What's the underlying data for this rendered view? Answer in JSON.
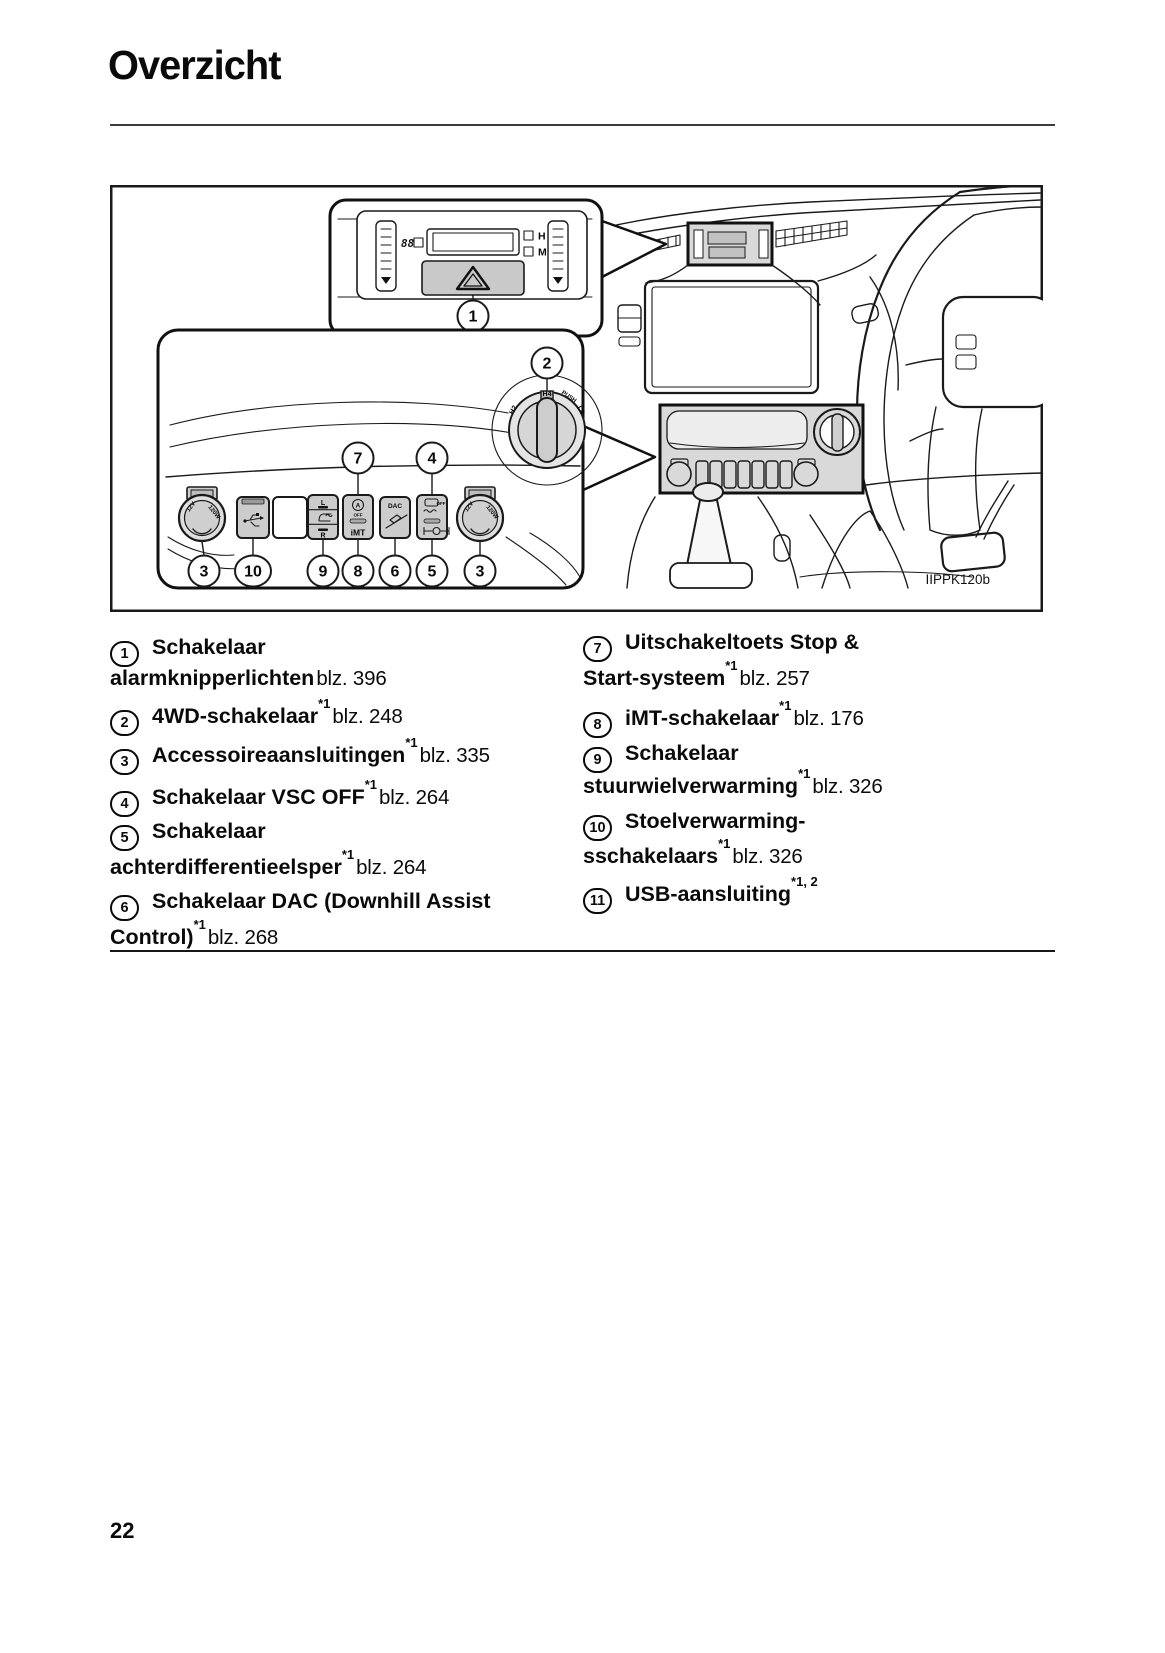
{
  "page": {
    "title": "Overzicht",
    "page_number": "22"
  },
  "diagram": {
    "figure_code": "IIPPK120b",
    "callouts": {
      "c1": "1",
      "c2": "2",
      "c3": "3",
      "c4": "4",
      "c5": "5",
      "c6": "6",
      "c7": "7",
      "c8": "8",
      "c9": "9",
      "c10": "10"
    },
    "labels": {
      "clock_digits": "88",
      "clock_hour": "H",
      "clock_minute": "M",
      "imt": "iMT",
      "dac": "DAC",
      "stopstart_a": "A",
      "stopstart_off": "OFF",
      "vsc_off": "OFF",
      "seat_left": "L",
      "seat_right": "R",
      "dial_h2": "H2",
      "dial_h4": "H4",
      "dial_l4": "L4",
      "dial_push": "PUSH",
      "outlet_12v": "12V",
      "outlet_120w": "120W"
    },
    "colors": {
      "highlight_gray": "#d9d9d9",
      "line": "#1a1a1a"
    }
  },
  "legend": {
    "left": [
      {
        "num": "1",
        "text": "Schakelaar",
        "sup": "",
        "page": ""
      },
      {
        "num": "",
        "text": "alarmknipperlichten",
        "sup": "",
        "page": "blz. 396"
      },
      {
        "num": "2",
        "text": "4WD-schakelaar",
        "sup": "*1",
        "page": "blz. 248"
      },
      {
        "num": "3",
        "text": "Accessoireaansluitingen",
        "sup": "*1",
        "page": "blz. 335"
      },
      {
        "num": "4",
        "text": "Schakelaar VSC OFF",
        "sup": "*1",
        "page": "blz. 264"
      },
      {
        "num": "5",
        "text": "Schakelaar",
        "sup": "",
        "page": ""
      },
      {
        "num": "",
        "text": "achterdifferentieelsper",
        "sup": "*1",
        "page": "blz. 264"
      },
      {
        "num": "6",
        "text": "Schakelaar DAC (Downhill Assist",
        "sup": "",
        "page": ""
      },
      {
        "num": "",
        "text": "Control)",
        "sup": "*1",
        "page": "blz. 268"
      }
    ],
    "right": [
      {
        "num": "7",
        "text": "Uitschakeltoets Stop &",
        "sup": "",
        "page": ""
      },
      {
        "num": "",
        "text": "Start-systeem",
        "sup": "*1",
        "page": "blz. 257"
      },
      {
        "num": "8",
        "text": "iMT-schakelaar",
        "sup": "*1",
        "page": "blz. 176"
      },
      {
        "num": "9",
        "text": "Schakelaar",
        "sup": "",
        "page": ""
      },
      {
        "num": "",
        "text": "stuurwielverwarming",
        "sup": "*1",
        "page": "blz. 326"
      },
      {
        "num": "10",
        "text": "Stoelverwarming-",
        "sup": "",
        "page": ""
      },
      {
        "num": "",
        "text": "sschakelaars",
        "sup": "*1",
        "page": "blz. 326"
      },
      {
        "num": "11",
        "text": "USB-aansluiting",
        "sup": "*1, 2",
        "page": ""
      }
    ]
  }
}
